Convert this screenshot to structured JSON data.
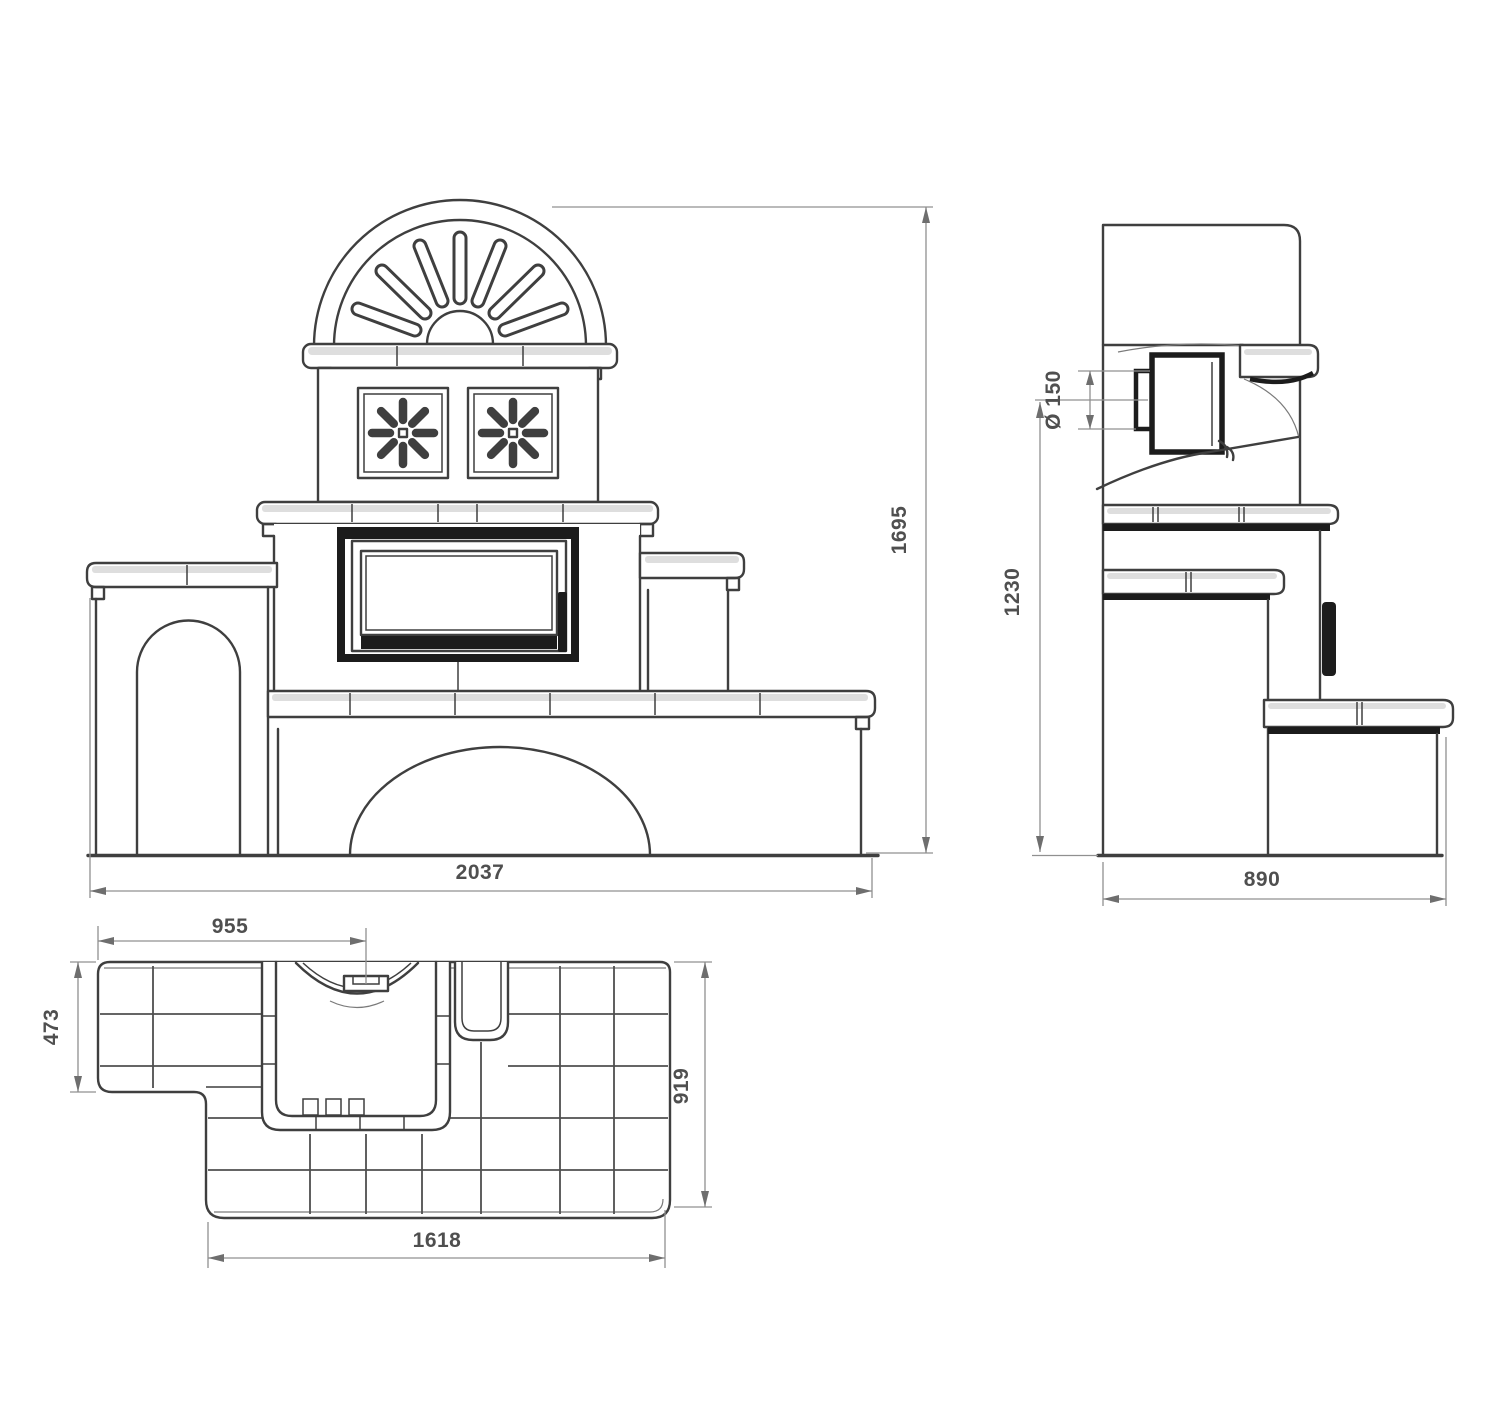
{
  "colors": {
    "ink": "#3f3f3f",
    "dark": "#1c1c1c",
    "shade": "#dedede",
    "dim": "#909090",
    "dimtext": "#4f4f4f",
    "bg": "#ffffff"
  },
  "views": {
    "front": {
      "dims": {
        "overall_width": "2037",
        "overall_height": "1695"
      }
    },
    "side": {
      "dims": {
        "overall_depth": "890",
        "flue_center_height": "1230",
        "flue_diameter": "Ø 150"
      }
    },
    "plan": {
      "dims": {
        "edge_to_door_center": "955",
        "bench_depth": "473",
        "body_depth": "919",
        "body_width": "1618"
      }
    }
  }
}
